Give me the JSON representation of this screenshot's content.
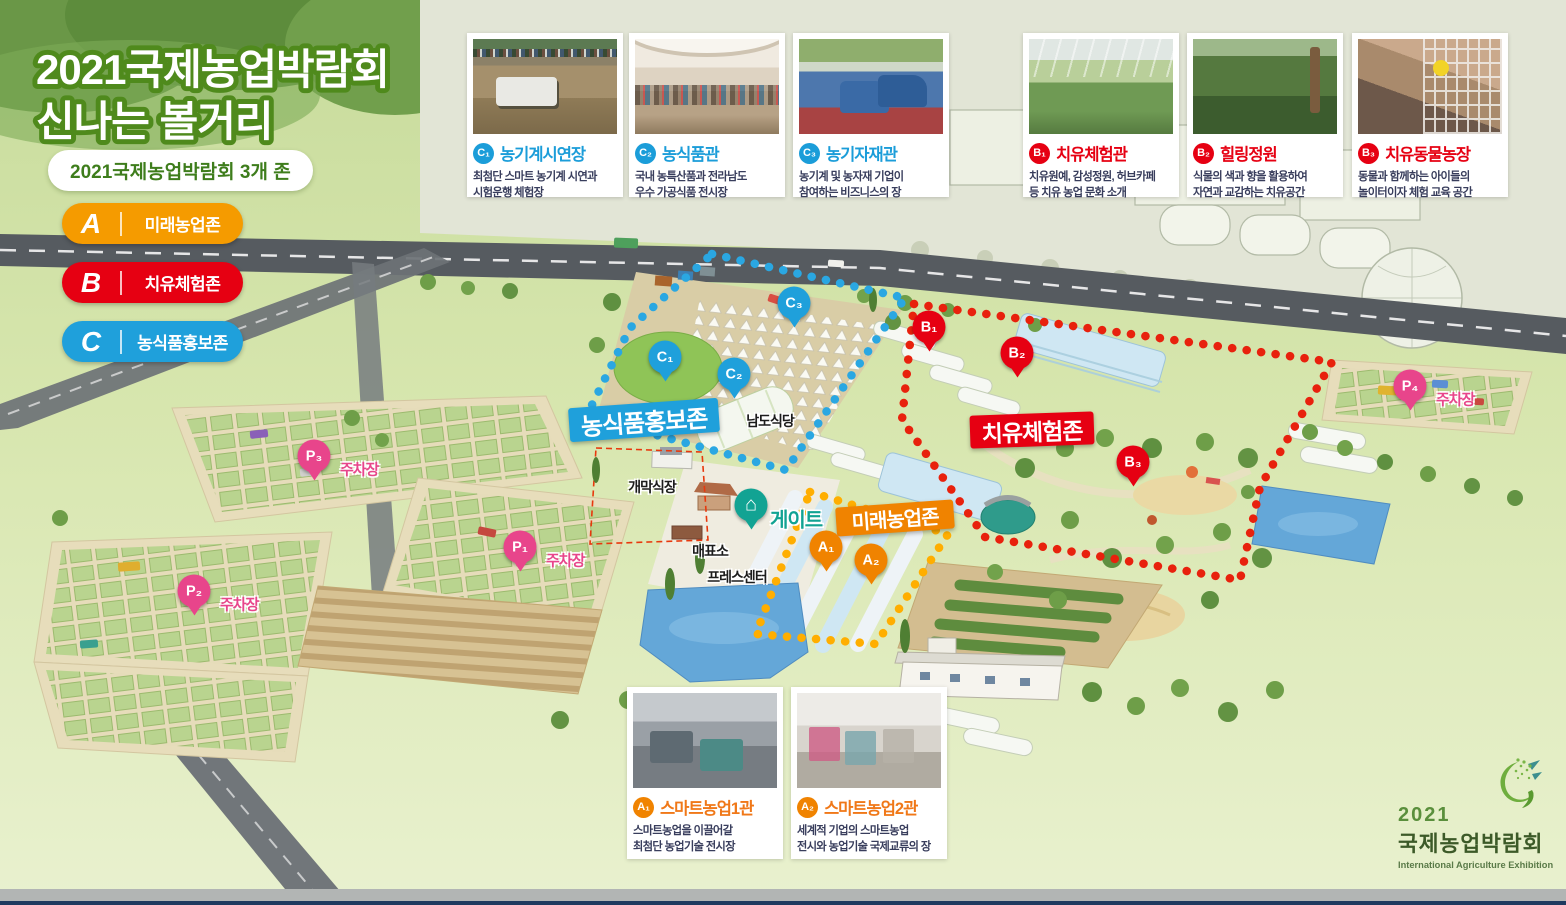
{
  "header": {
    "title_line1": "2021국제농업박람회",
    "title_line2": "신나는 볼거리",
    "subtitle_pill": "2021국제농업박람회 3개 존"
  },
  "legend": {
    "items": [
      {
        "letter": "A",
        "label": "미래농업존",
        "color": "#F59B00"
      },
      {
        "letter": "B",
        "label": "치유체험존",
        "color": "#E60012"
      },
      {
        "letter": "C",
        "label": "농식품홍보존",
        "color": "#1FA0DB"
      }
    ]
  },
  "cards": {
    "top": [
      {
        "id": "C₁",
        "zone": "C",
        "title": "농기계시연장",
        "desc1": "최첨단 스마트 농기계 시연과",
        "desc2": "시험운행 체험장"
      },
      {
        "id": "C₂",
        "zone": "C",
        "title": "농식품관",
        "desc1": "국내 농특산품과 전라남도",
        "desc2": "우수 가공식품 전시장"
      },
      {
        "id": "C₃",
        "zone": "C",
        "title": "농기자재관",
        "desc1": "농기계 및 농자재 기업이",
        "desc2": "참여하는 비즈니스의 장"
      },
      {
        "id": "B₁",
        "zone": "B",
        "title": "치유체험관",
        "desc1": "치유원예, 감성정원, 허브카페",
        "desc2": "등 치유 농업 문화 소개"
      },
      {
        "id": "B₂",
        "zone": "B",
        "title": "힐링정원",
        "desc1": "식물의 색과 향을 활용하여",
        "desc2": "자연과 교감하는 치유공간"
      },
      {
        "id": "B₃",
        "zone": "B",
        "title": "치유동물농장",
        "desc1": "동물과 함께하는 아이들의",
        "desc2": "놀이터이자 체험 교육 공간"
      }
    ],
    "bottom": [
      {
        "id": "A₁",
        "zone": "A",
        "title": "스마트농업1관",
        "desc1": "스마트농업을 이끌어갈",
        "desc2": "최첨단 농업기술 전시장"
      },
      {
        "id": "A₂",
        "zone": "A",
        "title": "스마트농업2관",
        "desc1": "세계적 기업의 스마트농업",
        "desc2": "전시와 농업기술 국제교류의 장"
      }
    ]
  },
  "map": {
    "zone_ribbons": [
      {
        "label": "농식품홍보존",
        "color": "#1FA0DB"
      },
      {
        "label": "치유체험존",
        "color": "#E60012"
      },
      {
        "label": "미래농업존",
        "color": "#F08300"
      }
    ],
    "pins": [
      {
        "label": "C₁"
      },
      {
        "label": "C₂"
      },
      {
        "label": "C₃"
      },
      {
        "label": "B₁"
      },
      {
        "label": "B₂"
      },
      {
        "label": "B₃"
      },
      {
        "label": "A₁"
      },
      {
        "label": "A₂"
      }
    ],
    "parking": [
      {
        "label": "P₃",
        "caption": "주차장"
      },
      {
        "label": "P₁",
        "caption": "주차장"
      },
      {
        "label": "P₂",
        "caption": "주차장"
      },
      {
        "label": "P₄",
        "caption": "주차장"
      }
    ],
    "gate": {
      "label": "게이트",
      "icon": "home-icon"
    },
    "facilities": [
      {
        "label": "남도식당"
      },
      {
        "label": "개막식장"
      },
      {
        "label": "매표소"
      },
      {
        "label": "프레스센터"
      }
    ],
    "colors": {
      "zone_a": "#F08300",
      "zone_a_dots": "#FFAE00",
      "zone_b": "#E60012",
      "zone_c": "#1FA0DB",
      "parking_pink": "#E8458B",
      "gate_teal": "#12A393"
    }
  },
  "logo": {
    "year": "2021",
    "name": "국제농업박람회",
    "subtitle": "International Agriculture Exhibition"
  }
}
